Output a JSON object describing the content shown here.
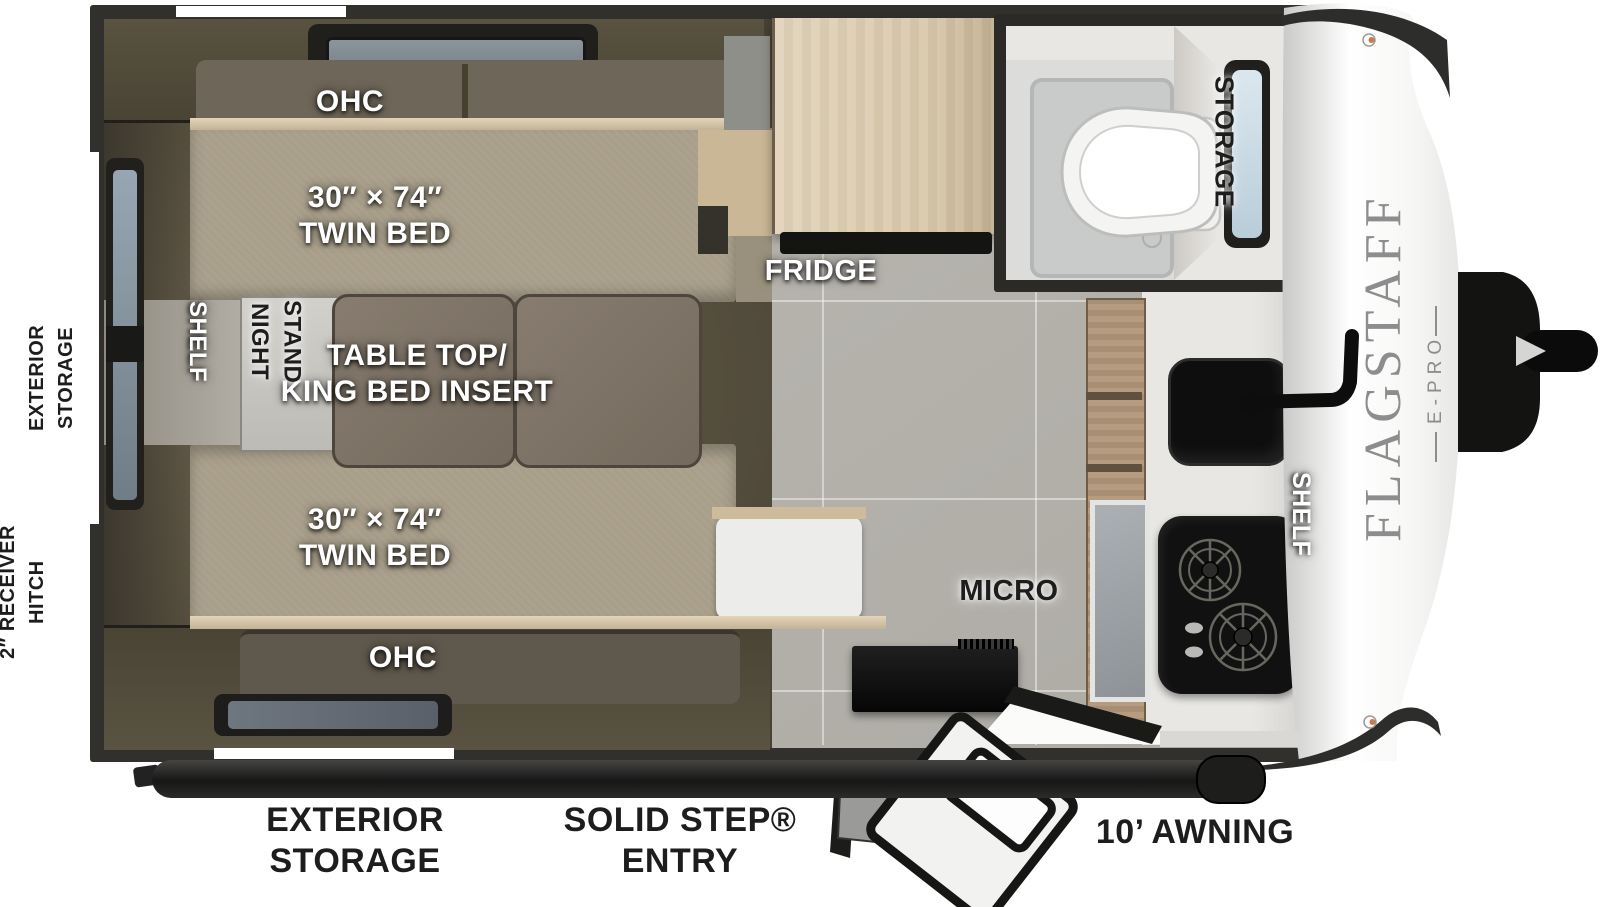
{
  "floorplan": {
    "exterior": {
      "rear_storage": "EXTERIOR\nSTORAGE",
      "receiver_hitch": "2″ RECEIVER\nHITCH",
      "bottom_storage": "EXTERIOR\nSTORAGE",
      "entry": "SOLID STEP®\nENTRY",
      "awning": "10’ AWNING"
    },
    "interior": {
      "ohc_top": "OHC",
      "ohc_bottom": "OHC",
      "bed_top": "30″ × 74″\nTWIN BED",
      "bed_bottom": "30″ × 74″\nTWIN BED",
      "table": "TABLE TOP/\nKING BED INSERT",
      "shelf_rear": "SHELF",
      "night_stand": "NIGHT\nSTAND",
      "fridge": "FRIDGE",
      "micro": "MICRO",
      "shelf_kitchen": "SHELF",
      "bath_storage": "STORAGE"
    },
    "brand": {
      "name": "FLAGSTAFF",
      "sub": "E-PRO"
    },
    "palette": {
      "wall": "#32302c",
      "interior_dark": "#57503f",
      "bed_fabric": "#a89e8a",
      "table_top": "#7d7266",
      "fridge_wood": "#dbcbae",
      "kitchen_wood": "#b1977a",
      "floor_tile": "#b4b1ab",
      "appliance_black": "#121212",
      "exterior_white": "#f4f4f4",
      "window_glass": "#cfdfe9",
      "label_white": "#ffffff",
      "label_black": "#1d1d1d",
      "brand_gray": "#8d8d8d"
    }
  }
}
